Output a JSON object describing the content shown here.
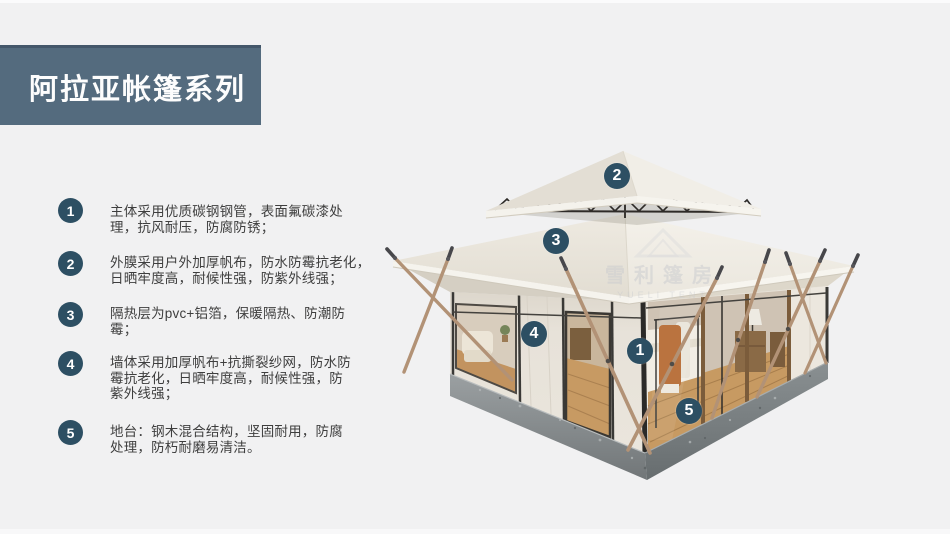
{
  "page": {
    "background_color": "#f1f1f2",
    "accent_color": "#2d4f63",
    "header_bg_color": "#546b7e"
  },
  "header": {
    "title": "阿拉亚帐篷系列"
  },
  "features": [
    {
      "num": "1",
      "text": "主体采用优质碳钢钢管，表面氟碳漆处\n理，抗风耐压，防腐防锈；"
    },
    {
      "num": "2",
      "text": "外膜采用户外加厚帆布，防水防霉抗老化，\n日晒牢度高，耐候性强，防紫外线强；"
    },
    {
      "num": "3",
      "text": "隔热层为pvc+铝箔，保暖隔热、防潮防\n霉；"
    },
    {
      "num": "4",
      "text": "墙体采用加厚帆布+抗撕裂纱网，防水防\n霉抗老化，日晒牢度高，耐候性强，防\n紫外线强；"
    },
    {
      "num": "5",
      "text": "地台：钢木混合结构，坚固耐用，防腐\n处理，防朽耐磨易清洁。"
    }
  ],
  "tent": {
    "callouts": [
      {
        "num": "1"
      },
      {
        "num": "2"
      },
      {
        "num": "3"
      },
      {
        "num": "4"
      },
      {
        "num": "5"
      }
    ],
    "watermark": {
      "cn": "雪利篷房",
      "en": "YUELI TENT"
    }
  }
}
